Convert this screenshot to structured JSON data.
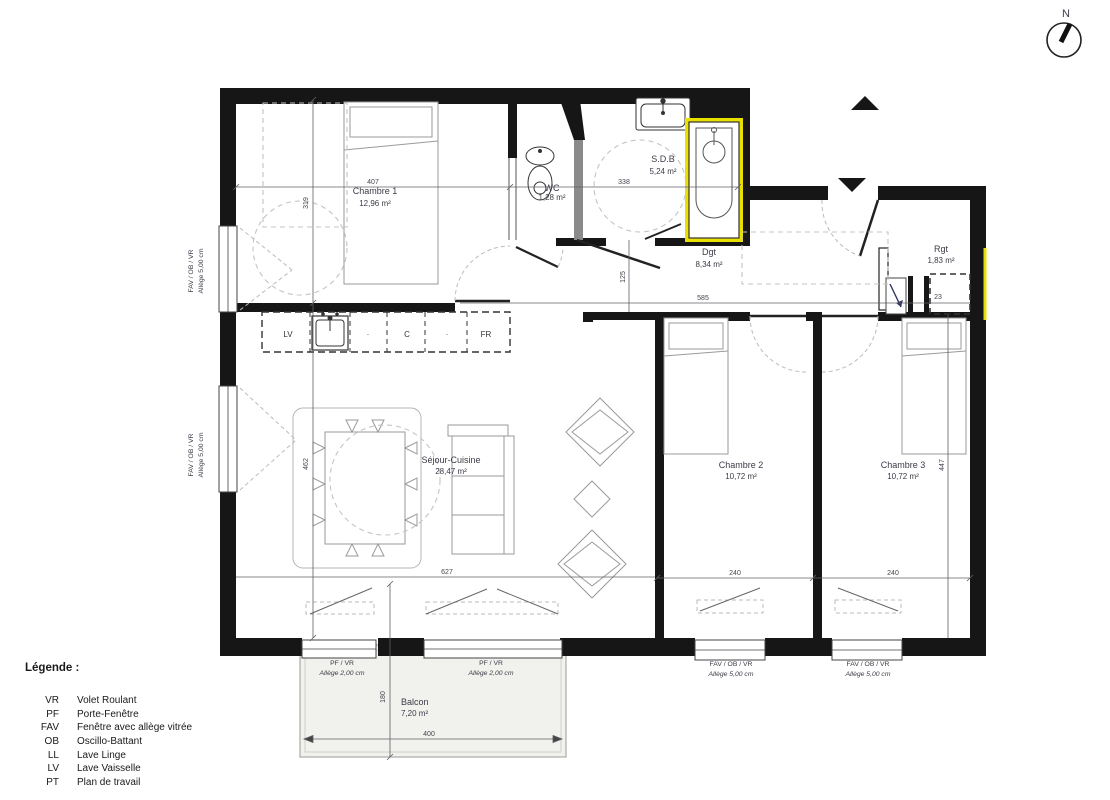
{
  "compass": {
    "north_label": "N"
  },
  "rooms": [
    {
      "name": "Chambre 1",
      "area": "12,96 m²"
    },
    {
      "name": "WC",
      "area": "1,28 m²"
    },
    {
      "name": "S.D.B",
      "area": "5,24 m²"
    },
    {
      "name": "Dgt",
      "area": "8,34 m²"
    },
    {
      "name": "Rgt",
      "area": "1,83 m²"
    },
    {
      "name": "Séjour-Cuisine",
      "area": "28,47 m²"
    },
    {
      "name": "Chambre 2",
      "area": "10,72 m²"
    },
    {
      "name": "Chambre 3",
      "area": "10,72 m²"
    },
    {
      "name": "Balcon",
      "area": "7,20 m²"
    }
  ],
  "kitchen": {
    "lv": "LV",
    "dot1": ".",
    "c": "C",
    "dot2": ".",
    "fr": "FR"
  },
  "dimensions": {
    "d407": "407",
    "d319": "319",
    "d338": "338",
    "d585": "585",
    "d125": "125",
    "d23": "23",
    "d462": "462",
    "d627": "627",
    "d240a": "240",
    "d240b": "240",
    "d447": "447",
    "d400": "400",
    "d180": "180"
  },
  "window_labels": {
    "left1_type": "FAV / OB / VR",
    "left1_allege": "Allège  5,00 cm",
    "left2_type": "FAV / OB / VR",
    "left2_allege": "Allège  5,00 cm",
    "pf1_type": "PF / VR",
    "pf1_allege": "Allège  2,00 cm",
    "pf2_type": "PF / VR",
    "pf2_allege": "Allège  2,00 cm",
    "ch2_type": "FAV / OB / VR",
    "ch2_allege": "Allège  5,00 cm",
    "ch3_type": "FAV / OB / VR",
    "ch3_allege": "Allège  5,00 cm"
  },
  "legend": {
    "title": "Légende :",
    "items": [
      {
        "abbr": "VR",
        "label": "Volet Roulant"
      },
      {
        "abbr": "PF",
        "label": "Porte-Fenêtre"
      },
      {
        "abbr": "FAV",
        "label": "Fenêtre avec allège vitrée"
      },
      {
        "abbr": "OB",
        "label": "Oscillo-Battant"
      },
      {
        "abbr": "LL",
        "label": "Lave Linge"
      },
      {
        "abbr": "LV",
        "label": "Lave Vaisselle"
      },
      {
        "abbr": "PT",
        "label": "Plan de travail"
      }
    ]
  },
  "colors": {
    "wall_black": "#161616",
    "tub_highlight_yellow": "#e9e000",
    "party_wall_yellow": "#e9e000",
    "balcony_gray": "#f1f1ee"
  }
}
